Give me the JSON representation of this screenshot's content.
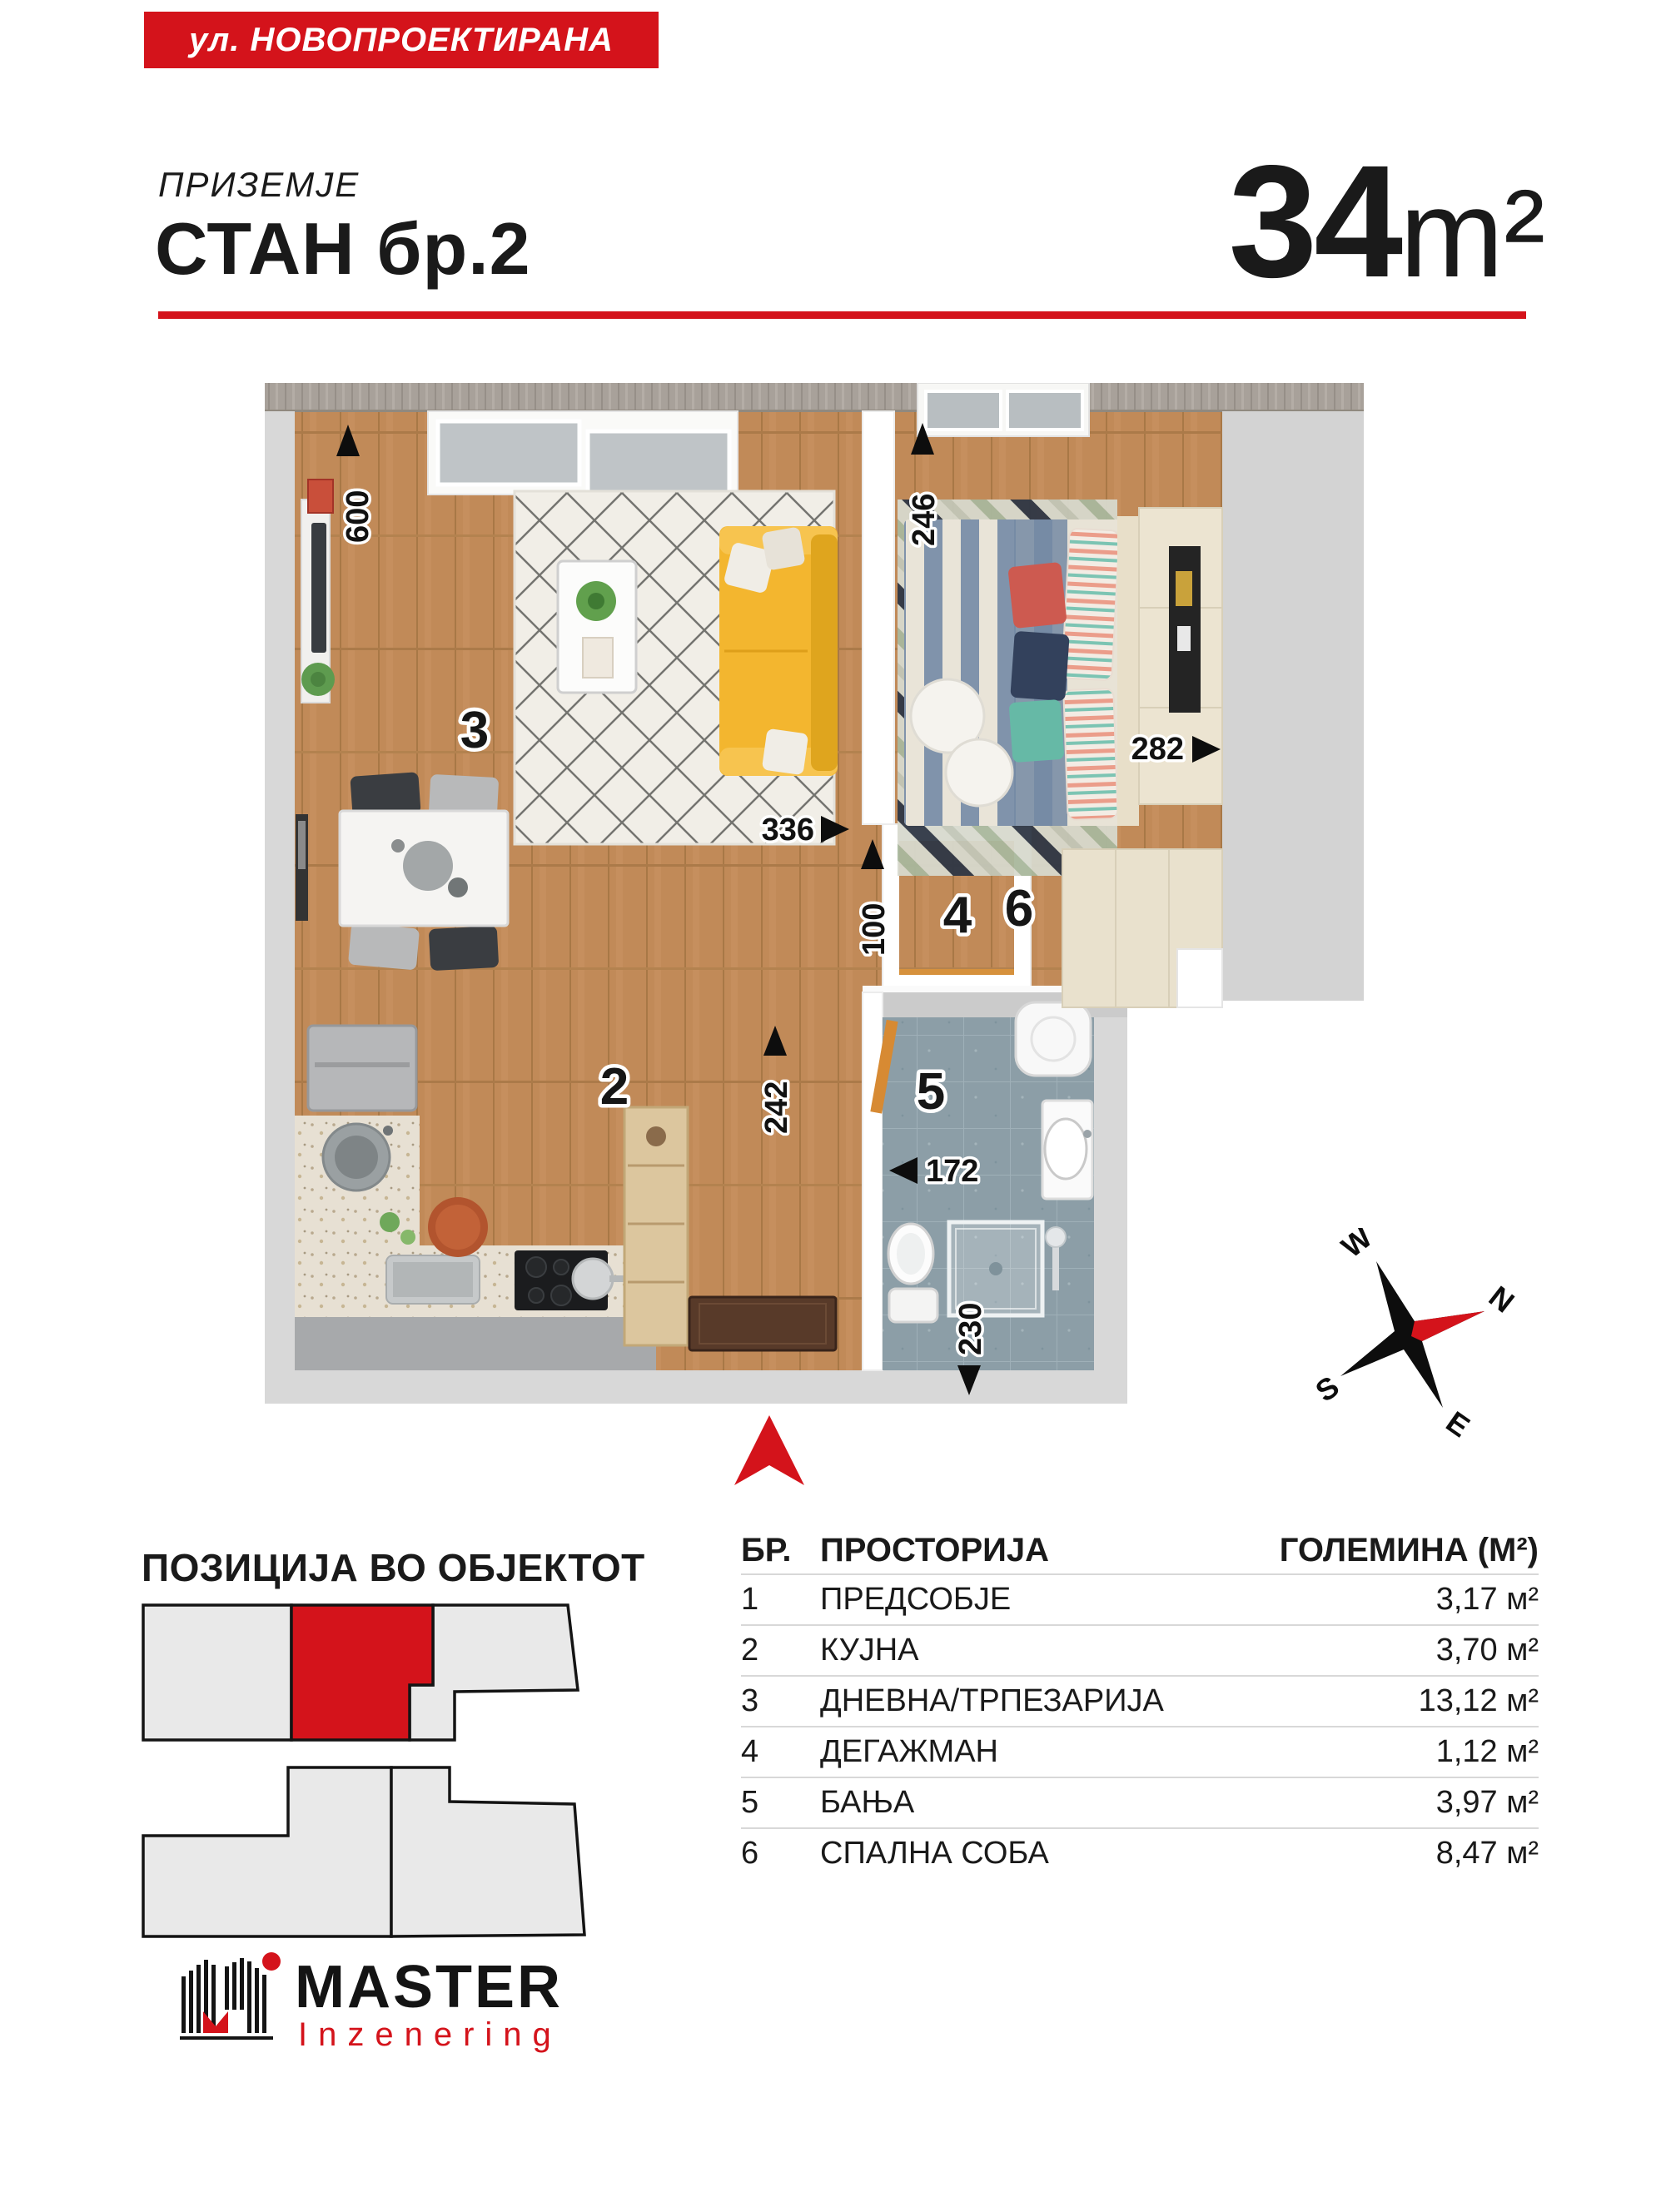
{
  "banner": {
    "street": "ул. НОВОПРОЕКТИРАНА"
  },
  "header": {
    "floor_label": "ПРИЗЕМЈЕ",
    "unit_label": "СТАН бр.2",
    "area": "34",
    "area_unit": "m²"
  },
  "plan": {
    "rooms": {
      "r2": "2",
      "r3": "3",
      "r4": "4",
      "r5": "5",
      "r6": "6"
    },
    "dims": {
      "west": "600",
      "bedroom_top": "246",
      "bedroom_right": "282",
      "living_south": "336",
      "passage": "100",
      "hall": "242",
      "bath_width": "172",
      "bath_depth": "230"
    }
  },
  "compass": {
    "n": "N",
    "e": "E",
    "s": "S",
    "w": "W"
  },
  "position_section": {
    "heading": "ПОЗИЦИЈА ВО ОБЈЕКТОТ"
  },
  "table": {
    "headers": {
      "num": "БР.",
      "room": "ПРОСТОРИЈА",
      "size": "ГОЛЕМИНА (М²)"
    },
    "rows": [
      {
        "num": "1",
        "name": "ПРЕДСОБЈЕ",
        "size": "3,17 м²"
      },
      {
        "num": "2",
        "name": "КУЈНА",
        "size": "3,70 м²"
      },
      {
        "num": "3",
        "name": "ДНЕВНА/ТРПЕЗАРИЈА",
        "size": "13,12 м²"
      },
      {
        "num": "4",
        "name": "ДЕГАЖМАН",
        "size": "1,12 м²"
      },
      {
        "num": "5",
        "name": "БАЊА",
        "size": "3,97 м²"
      },
      {
        "num": "6",
        "name": "СПАЛНА СОБА",
        "size": "8,47 м²"
      }
    ]
  },
  "logo": {
    "name": "MASTER",
    "subtitle": "Inzenering"
  },
  "colors": {
    "accent_red": "#d4131b",
    "wall_gray": "#d8d8d8",
    "wood": "#c18a58",
    "tile": "#8c9ea7"
  }
}
